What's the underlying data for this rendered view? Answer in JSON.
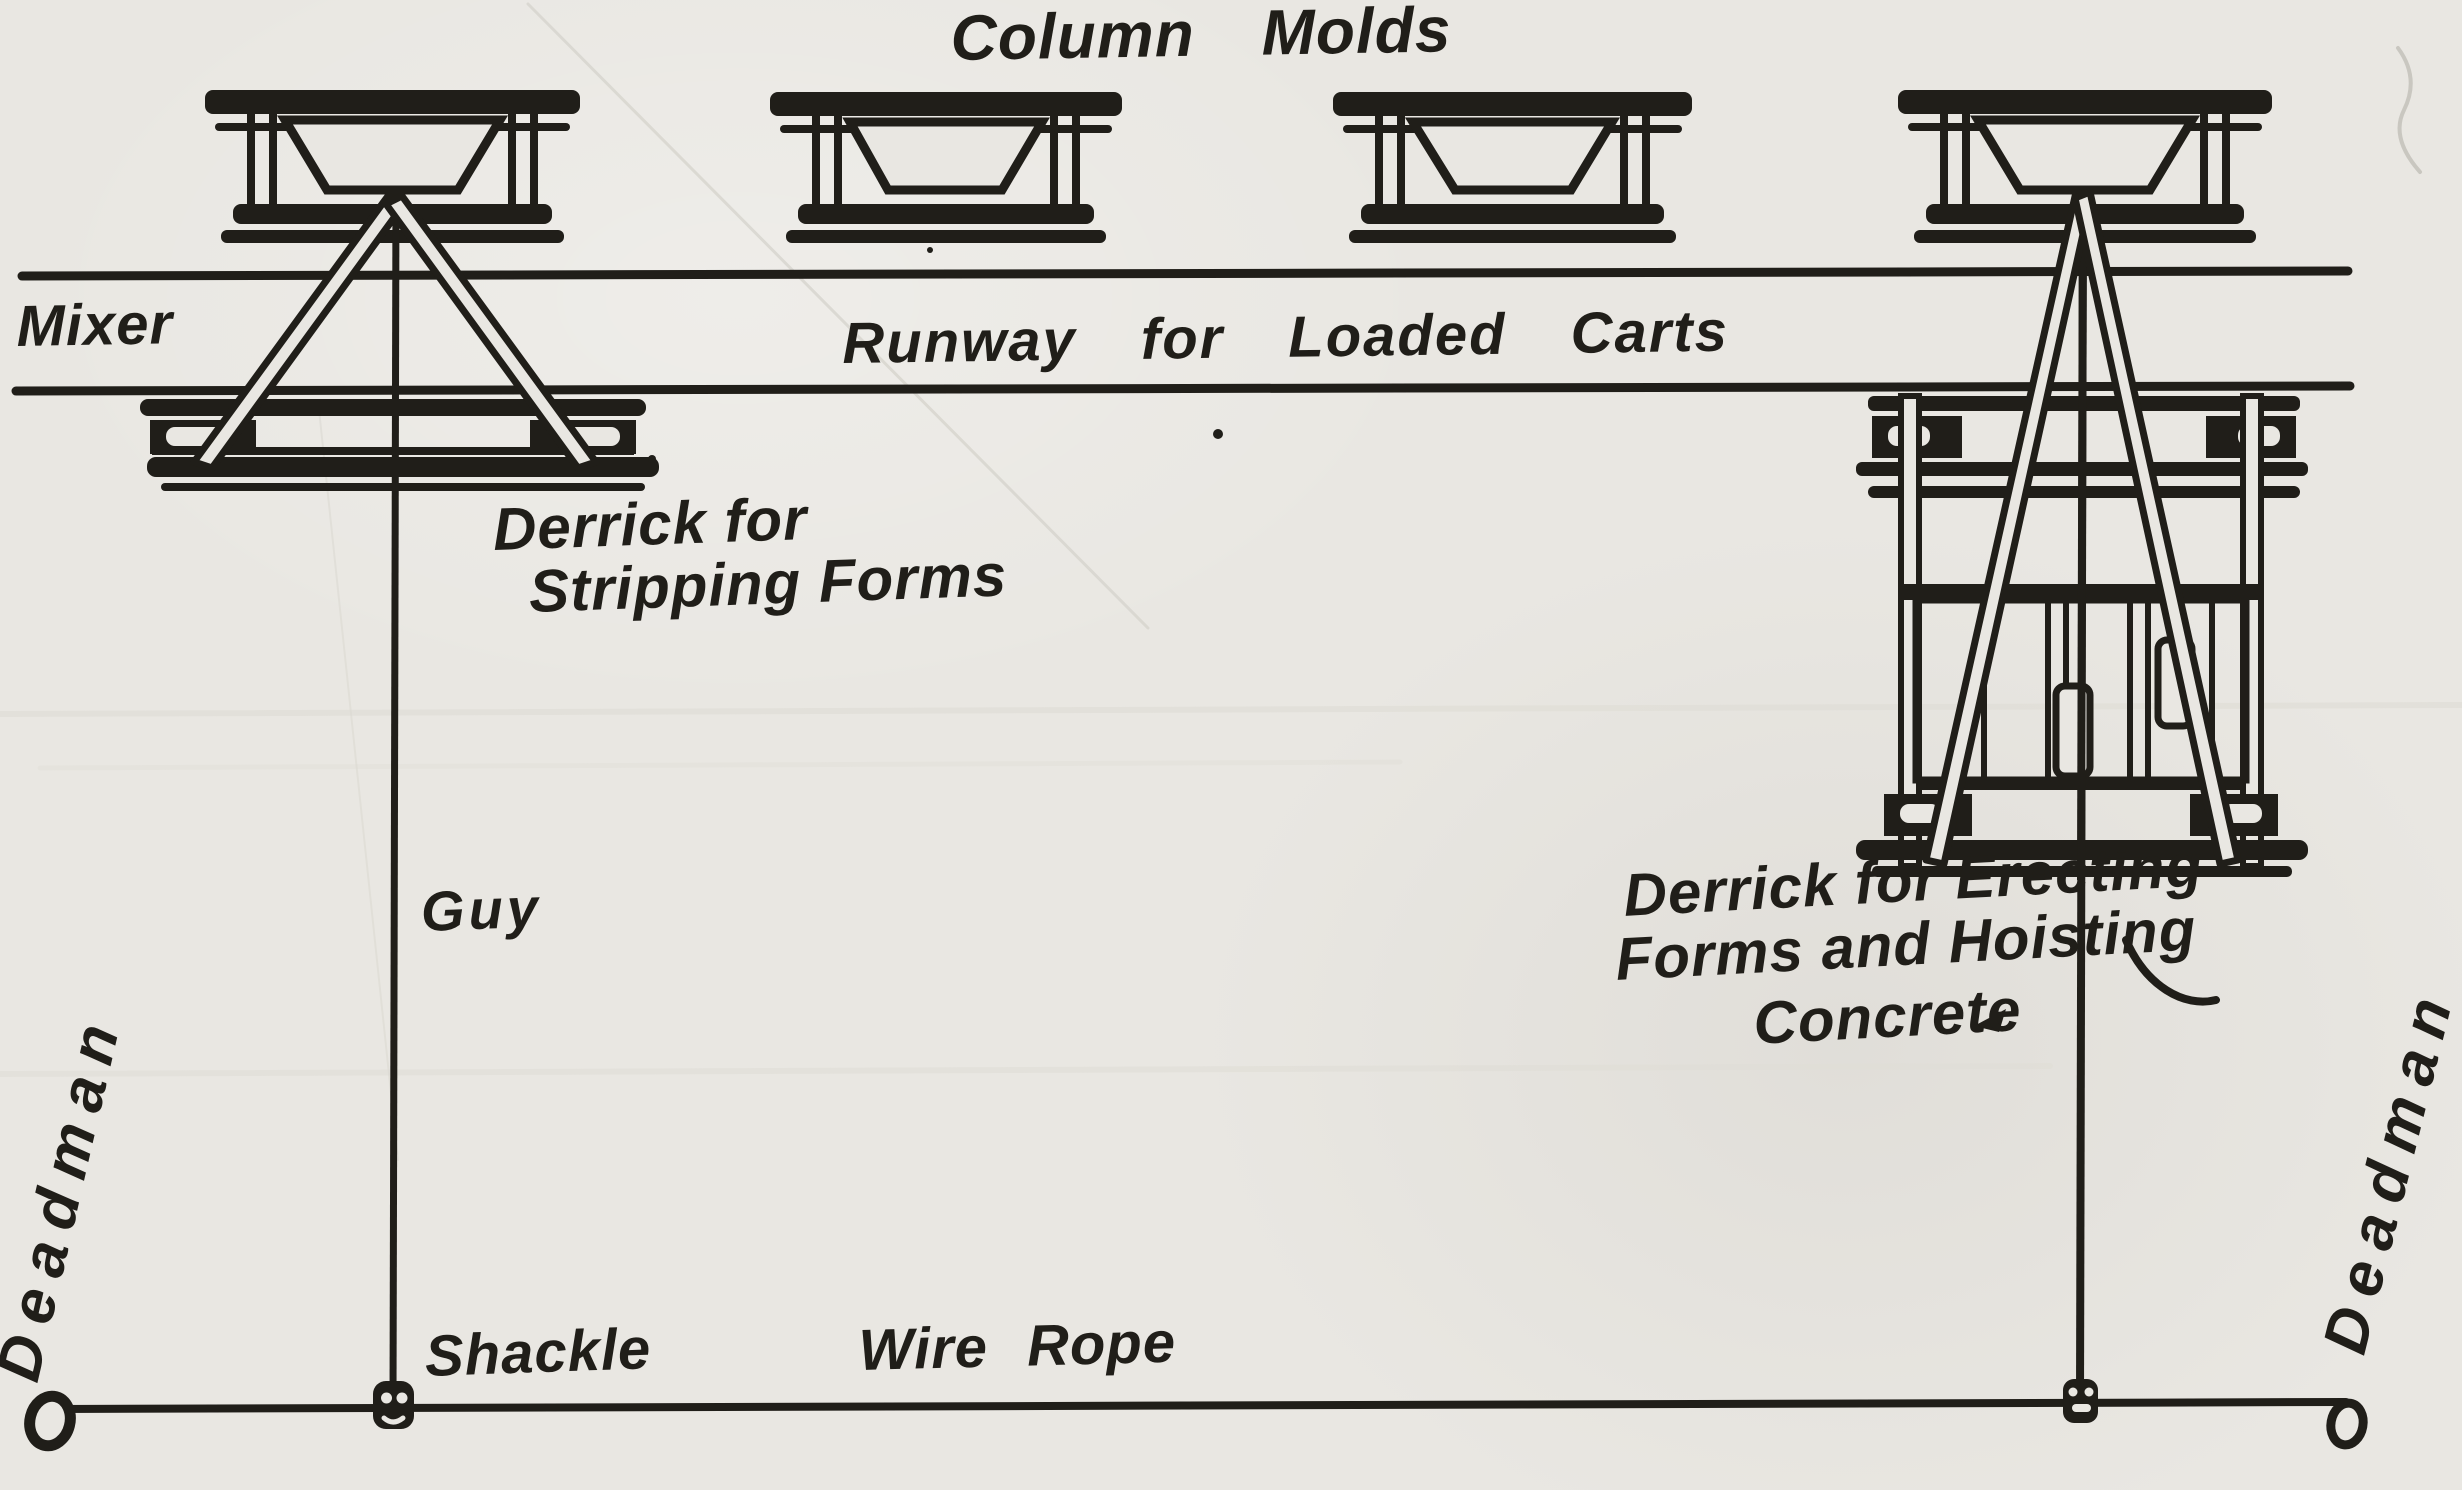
{
  "diagram": {
    "title": "Column Molds",
    "labels": {
      "mixer": "Mixer",
      "runway": "Runway for Loaded Carts",
      "derrick_left": {
        "line1": "Derrick for",
        "line2": "Stripping Forms"
      },
      "guy": "Guy",
      "derrick_right": {
        "line1": "Derrick for Erecting",
        "line2": "Forms and Hoisting",
        "line3": "Concrete"
      },
      "deadman_left": "Deadman",
      "deadman_right": "Deadman",
      "shackle": "Shackle",
      "wire_rope": "Wire Rope"
    },
    "colors": {
      "ink": "#201e19",
      "paper": "#e9e7e2"
    }
  }
}
